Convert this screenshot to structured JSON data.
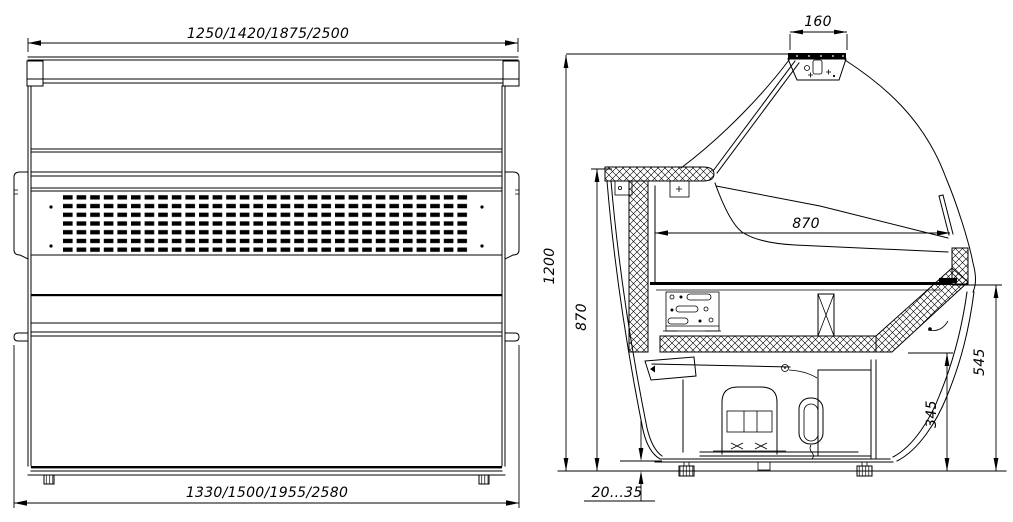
{
  "drawing": {
    "type": "technical-drawing-refrigerated-display-case",
    "background_color": "#ffffff",
    "line_color": "#000000",
    "front_view": {
      "overall_width_top": "1250/1420/1875/2500",
      "overall_width_bottom": "1330/1500/1955/2580"
    },
    "side_view": {
      "canopy_width": "160",
      "overall_height": "1200",
      "rear_counter_height": "870",
      "display_depth": "870",
      "front_height": "545",
      "base_height": "345",
      "foot_clearance": "20...35"
    }
  }
}
